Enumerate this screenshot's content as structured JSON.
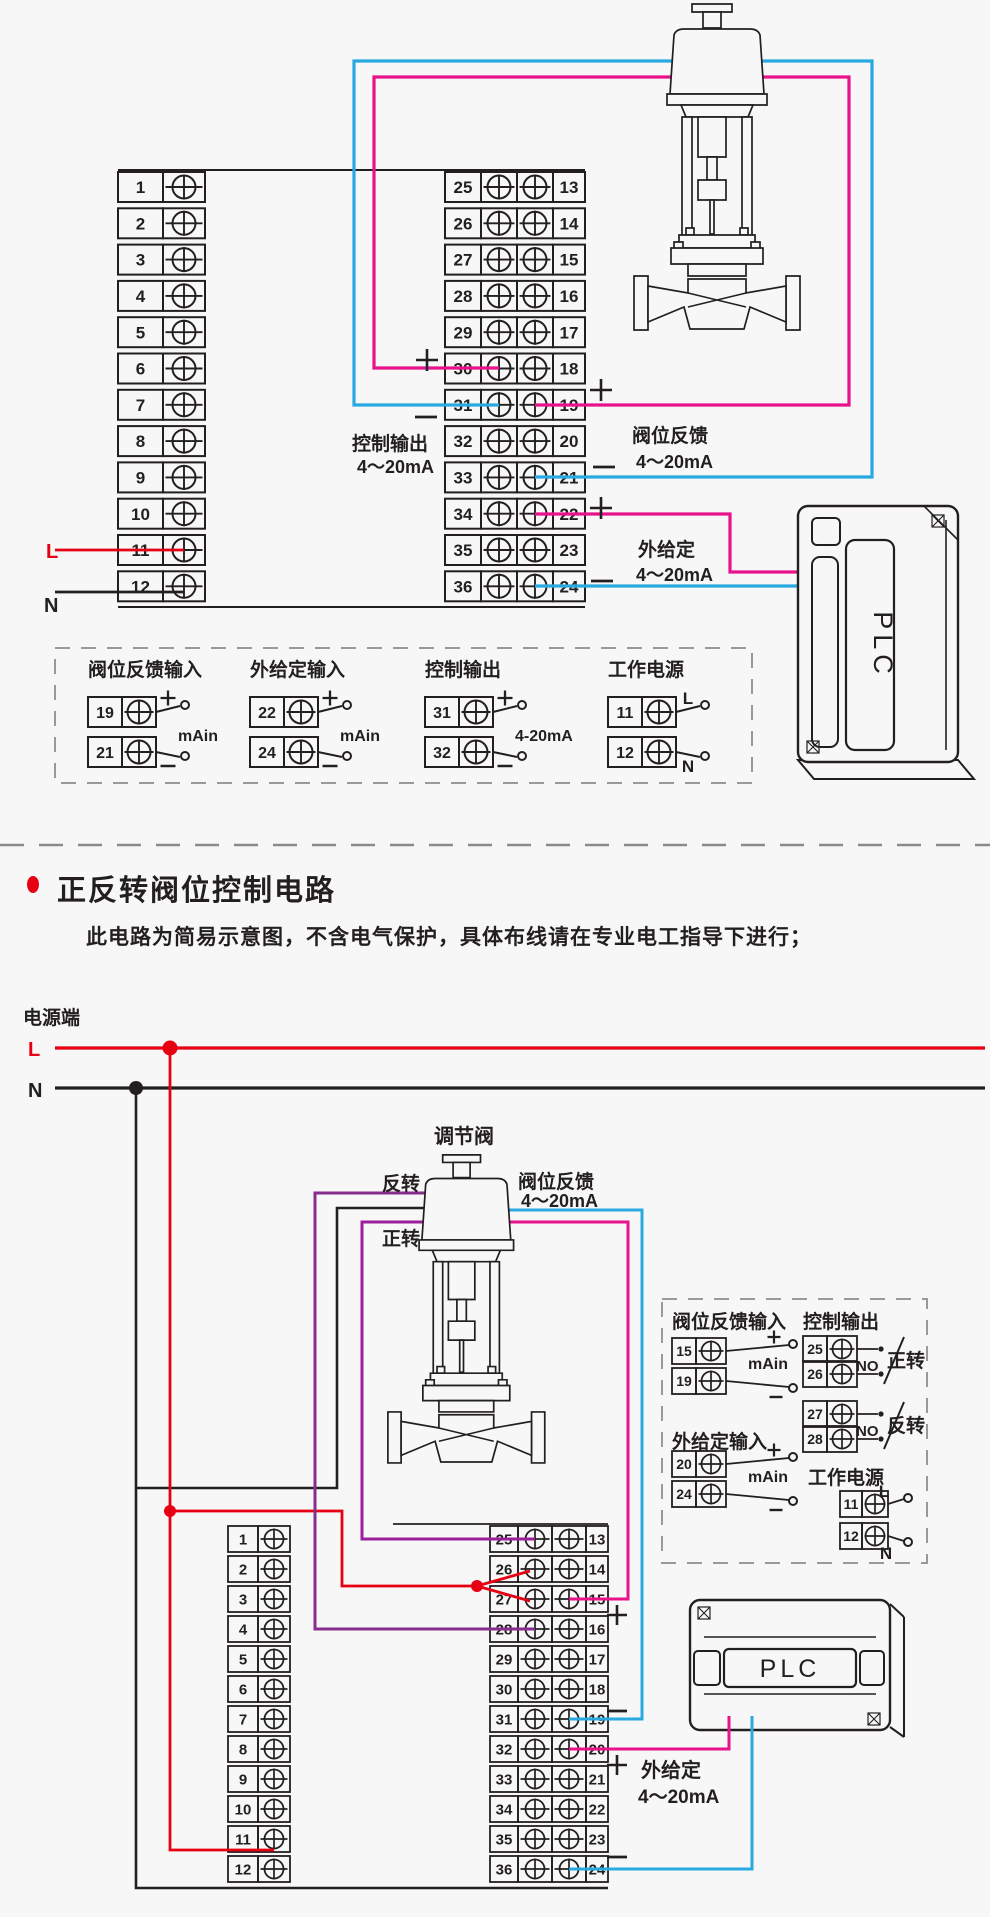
{
  "colors": {
    "background": "#f7f7f7",
    "ink": "#231f20",
    "red": "#e60012",
    "pink": "#e8128c",
    "blue": "#29a9e1",
    "purple_forward": "#9b1f9b",
    "purple_reverse": "#872d8d",
    "dash_gray": "#999999"
  },
  "title_block": {
    "title": "正反转阀位控制电路",
    "subtitle": "此电路为简易示意图，不含电气保护，具体布线请在专业电工指导下进行；"
  },
  "shared": {
    "plc": "PLC",
    "ma_in": "mAin",
    "no_contact": "NO",
    "plus": "+",
    "minus": "−",
    "live": "L",
    "neutral": "N"
  },
  "diagram1": {
    "terminals": {
      "left": [
        "1",
        "2",
        "3",
        "4",
        "5",
        "6",
        "7",
        "8",
        "9",
        "10",
        "11",
        "12"
      ],
      "mid_left": [
        "25",
        "26",
        "27",
        "28",
        "29",
        "30",
        "31",
        "32",
        "33",
        "34",
        "35",
        "36"
      ],
      "mid_right": [
        "13",
        "14",
        "15",
        "16",
        "17",
        "18",
        "19",
        "20",
        "21",
        "22",
        "23",
        "24"
      ]
    },
    "labels": {
      "live": "L",
      "neutral": "N",
      "control_output": "控制输出",
      "control_range": "4～20mA",
      "valve_feedback": "阀位反馈",
      "feedback_range": "4～20mA",
      "ext_setpoint": "外给定",
      "setpoint_range": "4～20mA",
      "plc": "PLC"
    },
    "detail_groups": [
      {
        "title": "阀位反馈输入",
        "top_no": "19",
        "bot_no": "21",
        "top_sign": "+",
        "bot_sign": "−",
        "mid": "mAin"
      },
      {
        "title": "外给定输入",
        "top_no": "22",
        "bot_no": "24",
        "top_sign": "+",
        "bot_sign": "−",
        "mid": "mAin"
      },
      {
        "title": "控制输出",
        "top_no": "31",
        "bot_no": "32",
        "top_sign": "+",
        "bot_sign": "−",
        "mid": "4-20mA"
      },
      {
        "title": "工作电源",
        "top_no": "11",
        "bot_no": "12",
        "top_sign": "L",
        "bot_sign": "N",
        "mid": ""
      }
    ]
  },
  "diagram2": {
    "power": {
      "terminal_label": "电源端",
      "live": "L",
      "neutral": "N"
    },
    "valve_label": "调节阀",
    "labels": {
      "reverse": "反转",
      "forward": "正转",
      "valve_feedback": "阀位反馈",
      "feedback_range": "4～20mA",
      "ext_setpoint": "外给定",
      "setpoint_range": "4～20mA",
      "plc": "PLC"
    },
    "terminals": {
      "left": [
        "1",
        "2",
        "3",
        "4",
        "5",
        "6",
        "7",
        "8",
        "9",
        "10",
        "11",
        "12"
      ],
      "mid_left": [
        "25",
        "26",
        "27",
        "28",
        "29",
        "30",
        "31",
        "32",
        "33",
        "34",
        "35",
        "36"
      ],
      "mid_right": [
        "13",
        "14",
        "15",
        "16",
        "17",
        "18",
        "19",
        "20",
        "21",
        "22",
        "23",
        "24"
      ]
    },
    "detail_groups": {
      "feedback": {
        "title": "阀位反馈输入",
        "top_no": "15",
        "bot_no": "19",
        "top_sign": "+",
        "bot_sign": "−",
        "mid": "mAin"
      },
      "control": {
        "title": "控制输出",
        "pairs": [
          {
            "top": "25",
            "bot": "26",
            "no": "NO",
            "dir": "正转"
          },
          {
            "top": "27",
            "bot": "28",
            "no": "NO",
            "dir": "反转"
          }
        ]
      },
      "setpoint": {
        "title": "外给定输入",
        "top_no": "20",
        "bot_no": "24",
        "top_sign": "+",
        "bot_sign": "−",
        "mid": "mAin"
      },
      "power": {
        "title": "工作电源",
        "top_no": "11",
        "bot_no": "12",
        "top_sign": "L",
        "bot_sign": "N"
      }
    }
  }
}
